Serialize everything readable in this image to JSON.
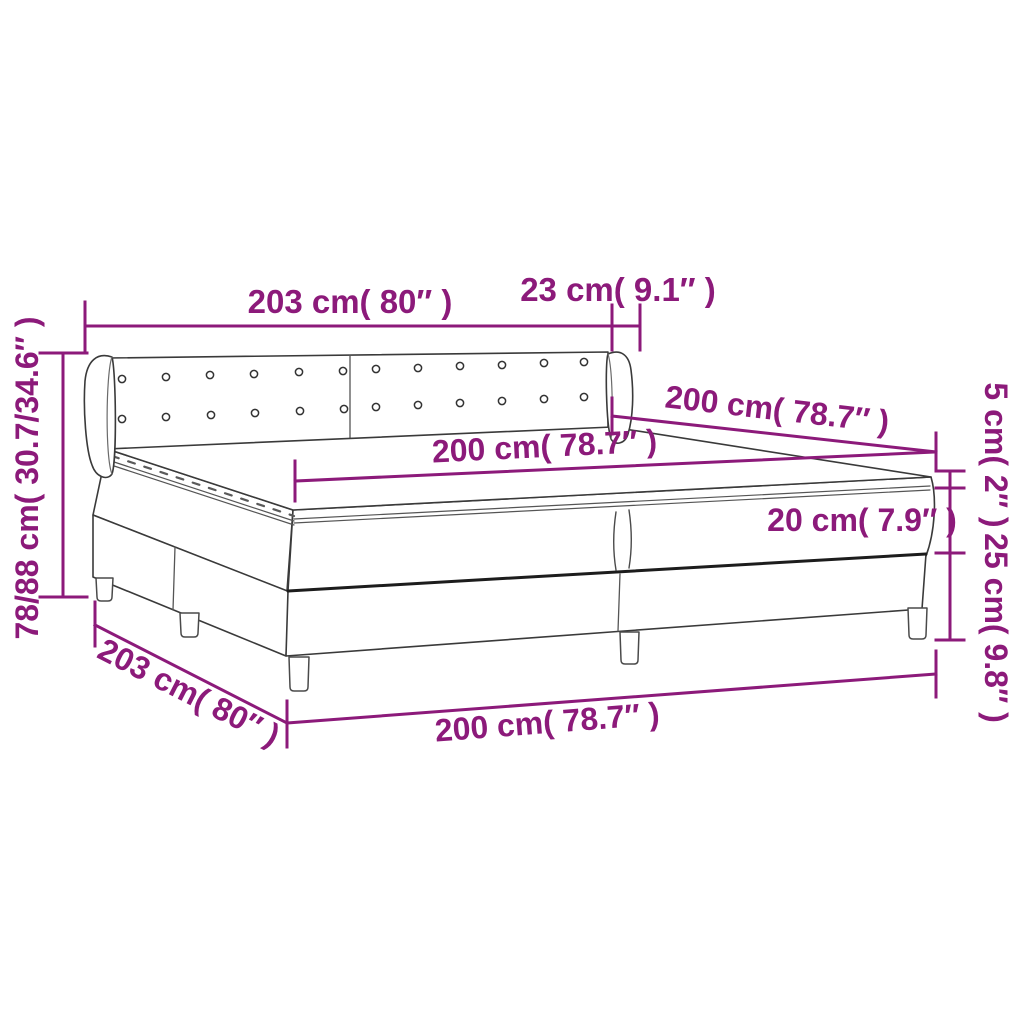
{
  "diagram": {
    "title": "box-spring-bed-dimension-diagram",
    "colors": {
      "dimension_accent": "#8c1a7a",
      "line_art": "#3a3a3a",
      "line_art_light": "#6a6a6a",
      "shadow_line": "#1c1c1c",
      "background": "#ffffff"
    },
    "labels": {
      "headboard_width": "203 cm( 80″ )",
      "wing_depth": "23 cm( 9.1″ )",
      "bed_length_top": "200 cm( 78.7″ )",
      "mattress_length": "200 cm( 78.7″ )",
      "headboard_height": "78/88 cm( 30.7/34.6″ )",
      "topper_height": "5 cm( 2″ )",
      "mattress_height": "20 cm( 7.9″ )",
      "box_spring_height": "25 cm( 9.8″ )",
      "bed_width_bottom": "203 cm( 80″ )",
      "bed_length_bottom": "200 cm( 78.7″ )"
    },
    "measurements": [
      {
        "name": "headboard width",
        "cm": "203",
        "inch": "80"
      },
      {
        "name": "headboard wing depth",
        "cm": "23",
        "inch": "9.1"
      },
      {
        "name": "bed length (top)",
        "cm": "200",
        "inch": "78.7"
      },
      {
        "name": "mattress length",
        "cm": "200",
        "inch": "78.7"
      },
      {
        "name": "headboard height range",
        "cm": "78/88",
        "inch": "30.7/34.6"
      },
      {
        "name": "topper thickness",
        "cm": "5",
        "inch": "2"
      },
      {
        "name": "mattress height",
        "cm": "20",
        "inch": "7.9"
      },
      {
        "name": "box spring height",
        "cm": "25",
        "inch": "9.8"
      },
      {
        "name": "bed width (bottom)",
        "cm": "203",
        "inch": "80"
      },
      {
        "name": "bed length (bottom)",
        "cm": "200",
        "inch": "78.7"
      }
    ]
  }
}
